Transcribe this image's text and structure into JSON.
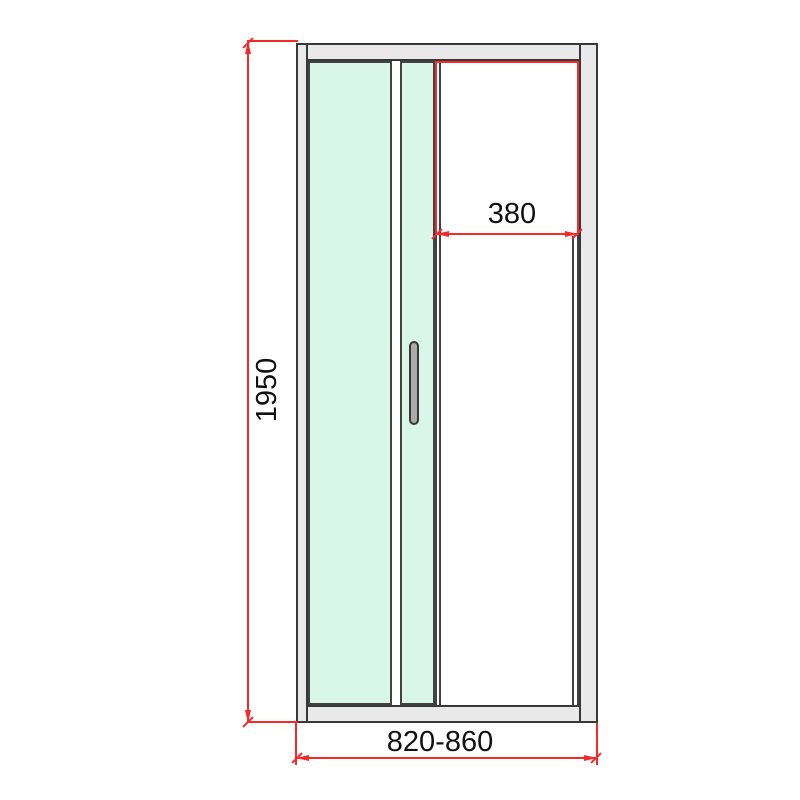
{
  "drawing": {
    "type": "technical-dimension-drawing",
    "subject": "shower door front elevation",
    "dimensions": {
      "height": "1950",
      "opening_width": "380",
      "overall_width_range": "820-860"
    },
    "colors": {
      "dimension_line": "#f62a2a",
      "glass": "#d8f7e9",
      "frame_fill": "#e9e9e9",
      "outline": "#383838",
      "background": "#ffffff"
    }
  }
}
